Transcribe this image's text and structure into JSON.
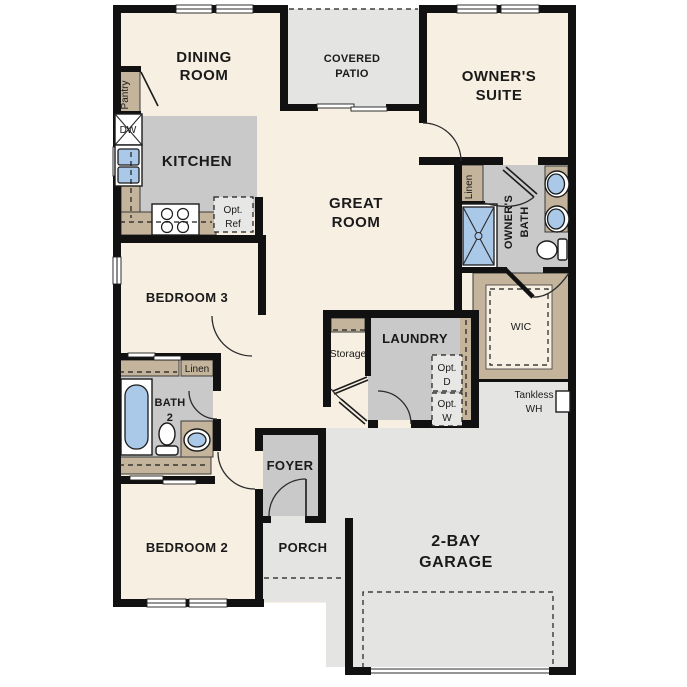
{
  "palette": {
    "floor_cream": "#f7efe1",
    "interior_room_gray": "#c9c9c9",
    "outdoor_concrete_gray": "#e4e4e2",
    "casework_tan": "#c3b49b",
    "fixture_blue": "#aac9e9",
    "wall_black": "#111111",
    "optional_item_fill": "#e7e7e5"
  },
  "rooms": {
    "dining": {
      "lines": [
        "DINING",
        "ROOM"
      ]
    },
    "covered_patio": {
      "lines": [
        "COVERED",
        "PATIO"
      ]
    },
    "owners_suite": {
      "lines": [
        "OWNER'S",
        "SUITE"
      ]
    },
    "kitchen": {
      "lines": [
        "KITCHEN"
      ]
    },
    "great_room": {
      "lines": [
        "GREAT",
        "ROOM"
      ]
    },
    "bedroom3": {
      "lines": [
        "BEDROOM 3"
      ]
    },
    "bedroom2": {
      "lines": [
        "BEDROOM 2"
      ]
    },
    "bath2": {
      "lines": [
        "BATH",
        "2"
      ]
    },
    "owners_bath": {
      "lines": [
        "OWNER'S",
        "BATH"
      ]
    },
    "wic": {
      "lines": [
        "WIC"
      ]
    },
    "laundry": {
      "lines": [
        "LAUNDRY"
      ]
    },
    "storage": {
      "lines": [
        "Storage"
      ]
    },
    "foyer": {
      "lines": [
        "FOYER"
      ]
    },
    "porch": {
      "lines": [
        "PORCH"
      ]
    },
    "garage": {
      "lines": [
        "2-BAY",
        "GARAGE"
      ]
    }
  },
  "closets": {
    "pantry": {
      "label": "Pantry"
    },
    "owners_linen": {
      "label": "Linen"
    },
    "hall_linen": {
      "label": "Linen"
    }
  },
  "appliances": {
    "dishwasher": {
      "label": "DW"
    },
    "optional_refrigerator": {
      "lines": [
        "Opt.",
        "Ref"
      ]
    },
    "optional_dryer": {
      "lines": [
        "Opt.",
        "D"
      ]
    },
    "optional_washer": {
      "lines": [
        "Opt.",
        "W"
      ]
    },
    "tankless_water_heater": {
      "lines": [
        "Tankless",
        "WH"
      ]
    }
  }
}
